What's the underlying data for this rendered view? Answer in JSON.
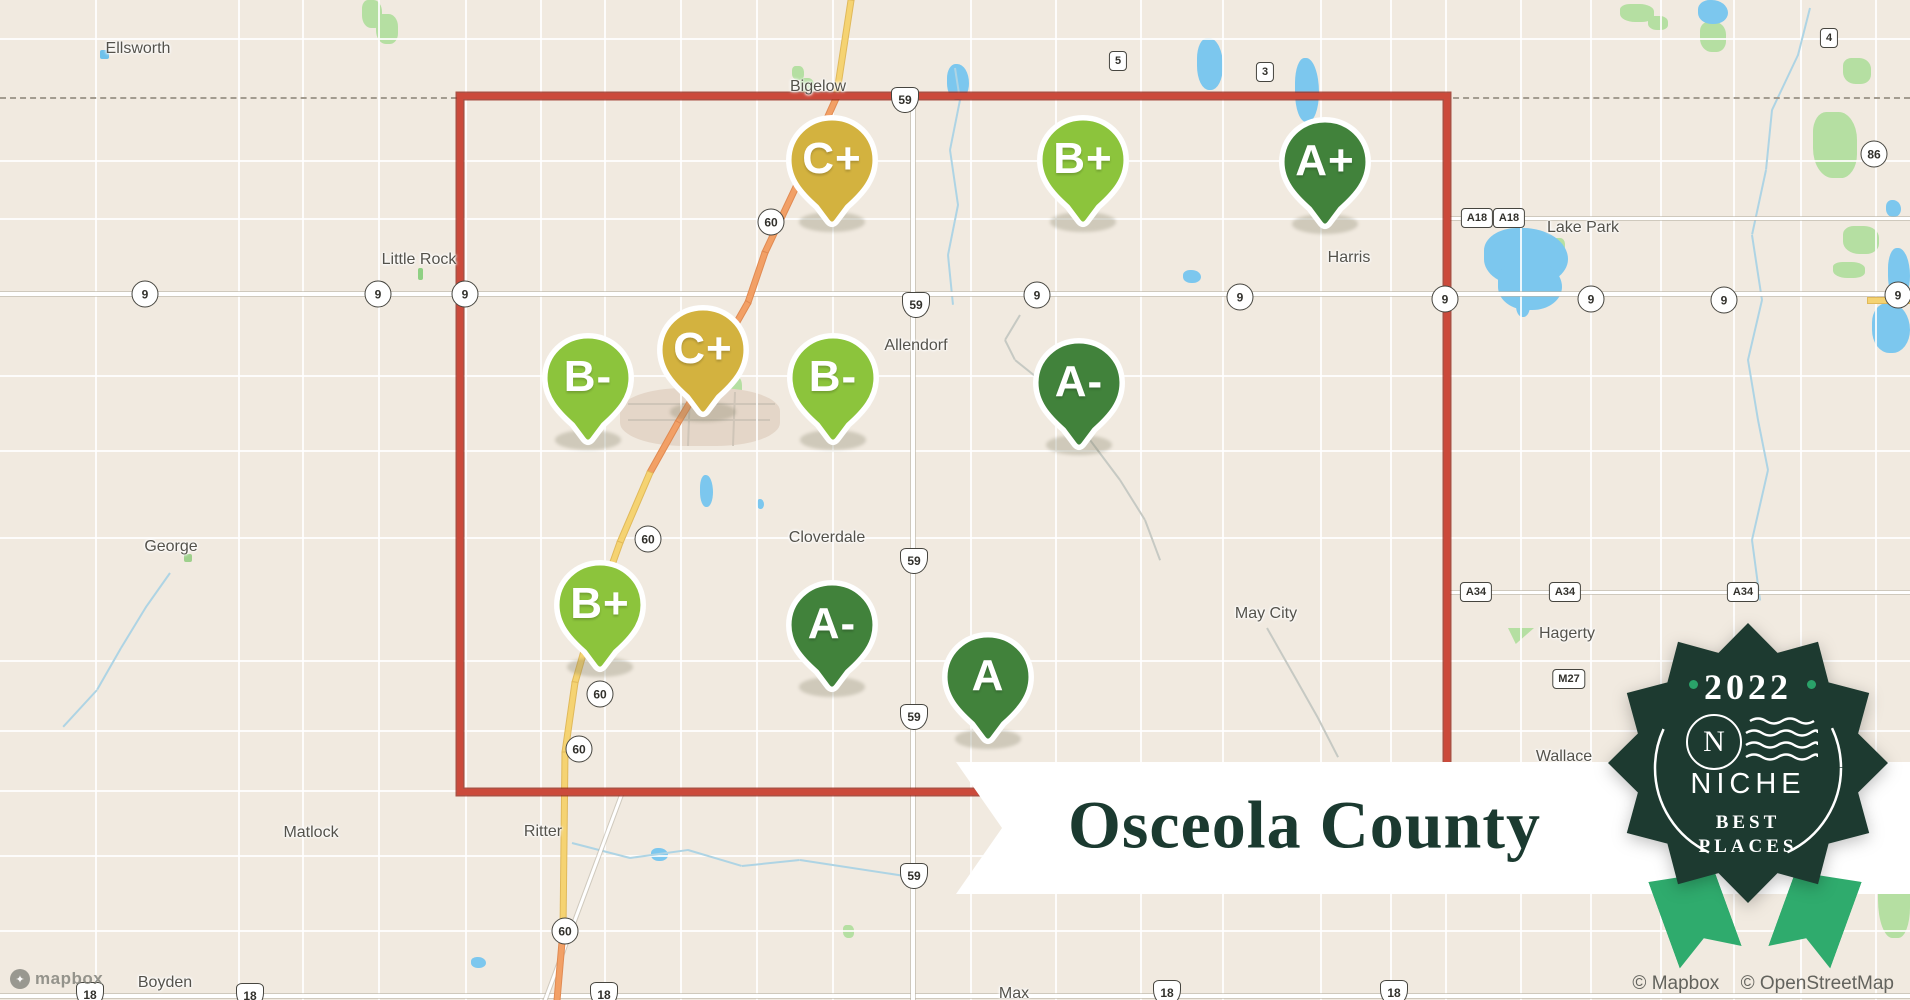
{
  "banner": {
    "title": "Osceola County"
  },
  "badge": {
    "year": "2022",
    "n": "N",
    "brand": "NICHE",
    "tagline1": "BEST",
    "tagline2": "PLACES"
  },
  "attribution": {
    "mapbox": "© Mapbox",
    "osm": "© OpenStreetMap"
  },
  "logo": {
    "text": "mapbox"
  },
  "colors": {
    "gold": "#d3b23f",
    "light_green": "#8cc43c",
    "dark_green": "#41823b",
    "county_border": "#cb4a3b",
    "water": "#7cc7ee",
    "park": "#b5dfa2",
    "road_yellow": "#f5d372",
    "road_orange": "#f2a066",
    "banner_text": "#1b3a30",
    "badge_bg": "#1d3a30",
    "ribbon": "#2fab6d",
    "badge_dot": "#2aa269"
  },
  "markers": [
    {
      "g": "C+",
      "tier": "gold",
      "x": 832,
      "y": 160
    },
    {
      "g": "B+",
      "tier": "light",
      "x": 1083,
      "y": 160
    },
    {
      "g": "A+",
      "tier": "dark",
      "x": 1325,
      "y": 162
    },
    {
      "g": "C+",
      "tier": "gold",
      "x": 703,
      "y": 350
    },
    {
      "g": "B-",
      "tier": "light",
      "x": 588,
      "y": 378
    },
    {
      "g": "B-",
      "tier": "light",
      "x": 833,
      "y": 378
    },
    {
      "g": "A-",
      "tier": "dark",
      "x": 1079,
      "y": 383
    },
    {
      "g": "B+",
      "tier": "light",
      "x": 600,
      "y": 605
    },
    {
      "g": "A-",
      "tier": "dark",
      "x": 832,
      "y": 625
    },
    {
      "g": "A",
      "tier": "dark",
      "x": 988,
      "y": 677
    }
  ],
  "towns": [
    {
      "name": "Ellsworth",
      "x": 138,
      "y": 49,
      "icon": {
        "c": "#6fc1ea",
        "x": 100,
        "y": 50,
        "w": 9,
        "h": 9
      }
    },
    {
      "name": "Bigelow",
      "x": 818,
      "y": 87
    },
    {
      "name": "Little Rock",
      "x": 419,
      "y": 260,
      "icon": {
        "c": "#8fd083",
        "x": 418,
        "y": 268,
        "w": 5,
        "h": 12
      }
    },
    {
      "name": "Harris",
      "x": 1349,
      "y": 258
    },
    {
      "name": "Lake Park",
      "x": 1583,
      "y": 228
    },
    {
      "name": "Allendorf",
      "x": 916,
      "y": 346
    },
    {
      "name": "George",
      "x": 171,
      "y": 547,
      "icon": {
        "c": "#9ed08c",
        "x": 184,
        "y": 554,
        "w": 8,
        "h": 8
      }
    },
    {
      "name": "Cloverdale",
      "x": 827,
      "y": 538
    },
    {
      "name": "May City",
      "x": 1266,
      "y": 614
    },
    {
      "name": "Hagerty",
      "x": 1567,
      "y": 634
    },
    {
      "name": "Wallace",
      "x": 1564,
      "y": 757
    },
    {
      "name": "Matlock",
      "x": 311,
      "y": 833
    },
    {
      "name": "Ritter",
      "x": 543,
      "y": 832
    },
    {
      "name": "Boyden",
      "x": 165,
      "y": 983
    },
    {
      "name": "Max",
      "x": 1014,
      "y": 994
    }
  ],
  "shields": [
    {
      "t": "c",
      "l": "9",
      "x": 145,
      "y": 294
    },
    {
      "t": "c",
      "l": "9",
      "x": 378,
      "y": 294
    },
    {
      "t": "c",
      "l": "9",
      "x": 465,
      "y": 294
    },
    {
      "t": "c",
      "l": "9",
      "x": 1037,
      "y": 295
    },
    {
      "t": "c",
      "l": "9",
      "x": 1240,
      "y": 297
    },
    {
      "t": "c",
      "l": "9",
      "x": 1445,
      "y": 299
    },
    {
      "t": "c",
      "l": "9",
      "x": 1591,
      "y": 299
    },
    {
      "t": "c",
      "l": "9",
      "x": 1724,
      "y": 300
    },
    {
      "t": "c",
      "l": "9",
      "x": 1898,
      "y": 295
    },
    {
      "t": "c",
      "l": "60",
      "x": 771,
      "y": 222
    },
    {
      "t": "c",
      "l": "60",
      "x": 648,
      "y": 539
    },
    {
      "t": "c",
      "l": "60",
      "x": 600,
      "y": 694
    },
    {
      "t": "c",
      "l": "60",
      "x": 579,
      "y": 749
    },
    {
      "t": "c",
      "l": "60",
      "x": 565,
      "y": 931
    },
    {
      "t": "c",
      "l": "86",
      "x": 1874,
      "y": 154
    },
    {
      "t": "u",
      "l": "59",
      "x": 905,
      "y": 100
    },
    {
      "t": "u",
      "l": "59",
      "x": 916,
      "y": 305
    },
    {
      "t": "u",
      "l": "59",
      "x": 914,
      "y": 561
    },
    {
      "t": "u",
      "l": "59",
      "x": 914,
      "y": 717
    },
    {
      "t": "u",
      "l": "59",
      "x": 914,
      "y": 876
    },
    {
      "t": "u",
      "l": "18",
      "x": 90,
      "y": 995
    },
    {
      "t": "u",
      "l": "18",
      "x": 250,
      "y": 996
    },
    {
      "t": "u",
      "l": "18",
      "x": 604,
      "y": 995
    },
    {
      "t": "u",
      "l": "18",
      "x": 1167,
      "y": 993
    },
    {
      "t": "u",
      "l": "18",
      "x": 1394,
      "y": 993
    },
    {
      "t": "b",
      "l": "5",
      "x": 1118,
      "y": 61
    },
    {
      "t": "b",
      "l": "3",
      "x": 1265,
      "y": 72
    },
    {
      "t": "b",
      "l": "4",
      "x": 1829,
      "y": 38
    },
    {
      "t": "b",
      "l": "A18",
      "x": 1477,
      "y": 218
    },
    {
      "t": "b",
      "l": "A18",
      "x": 1509,
      "y": 218
    },
    {
      "t": "b",
      "l": "A34",
      "x": 1476,
      "y": 592
    },
    {
      "t": "b",
      "l": "A34",
      "x": 1565,
      "y": 592
    },
    {
      "t": "b",
      "l": "A34",
      "x": 1743,
      "y": 592
    },
    {
      "t": "b",
      "l": "M27",
      "x": 1569,
      "y": 679
    }
  ],
  "map": {
    "grid": {
      "vx": [
        95,
        238,
        302,
        378,
        465,
        540,
        604,
        680,
        756,
        832,
        970,
        1055,
        1140,
        1222,
        1320,
        1390,
        1445,
        1520,
        1590,
        1660,
        1733,
        1800,
        1875
      ],
      "hy": [
        38,
        160,
        218,
        375,
        450,
        537,
        660,
        730,
        790,
        855,
        930
      ]
    },
    "roads_major": [
      {
        "x1": 0,
        "y1": 294,
        "x2": 1910,
        "y2": 294,
        "w": 4
      },
      {
        "x1": 0,
        "y1": 996,
        "x2": 1910,
        "y2": 996,
        "w": 4
      },
      {
        "x1": 913,
        "y1": 96,
        "x2": 913,
        "y2": 1000,
        "w": 4
      },
      {
        "x1": 1447,
        "y1": 592,
        "x2": 1910,
        "y2": 592,
        "w": 3
      },
      {
        "x1": 1447,
        "y1": 218,
        "x2": 1910,
        "y2": 218,
        "w": 3
      },
      {
        "x1": 622,
        "y1": 793,
        "x2": 545,
        "y2": 1000,
        "w": 3
      }
    ],
    "hwy60": [
      {
        "x1": 851,
        "y1": 0,
        "x2": 836,
        "y2": 98,
        "c": "y"
      },
      {
        "x1": 836,
        "y1": 98,
        "x2": 799,
        "y2": 180,
        "c": "o"
      },
      {
        "x1": 799,
        "y1": 180,
        "x2": 765,
        "y2": 252,
        "c": "o"
      },
      {
        "x1": 765,
        "y1": 252,
        "x2": 748,
        "y2": 302,
        "c": "o"
      },
      {
        "x1": 748,
        "y1": 302,
        "x2": 714,
        "y2": 362,
        "c": "o"
      },
      {
        "x1": 714,
        "y1": 362,
        "x2": 678,
        "y2": 422,
        "c": "o"
      },
      {
        "x1": 678,
        "y1": 422,
        "x2": 650,
        "y2": 472,
        "c": "o"
      },
      {
        "x1": 650,
        "y1": 472,
        "x2": 620,
        "y2": 542,
        "c": "y"
      },
      {
        "x1": 620,
        "y1": 542,
        "x2": 595,
        "y2": 612,
        "c": "y"
      },
      {
        "x1": 595,
        "y1": 612,
        "x2": 575,
        "y2": 682,
        "c": "y"
      },
      {
        "x1": 575,
        "y1": 682,
        "x2": 565,
        "y2": 752,
        "c": "y"
      },
      {
        "x1": 565,
        "y1": 752,
        "x2": 563,
        "y2": 930,
        "c": "y"
      },
      {
        "x1": 563,
        "y1": 930,
        "x2": 557,
        "y2": 1000,
        "c": "o"
      },
      {
        "x1": 1868,
        "y1": 300,
        "x2": 1910,
        "y2": 300,
        "c": "y"
      }
    ],
    "streams": [
      {
        "pts": [
          [
            955,
            68
          ],
          [
            960,
            100
          ],
          [
            950,
            150
          ],
          [
            958,
            205
          ],
          [
            948,
            255
          ],
          [
            953,
            305
          ]
        ]
      },
      {
        "pts": [
          [
            1810,
            8
          ],
          [
            1798,
            55
          ],
          [
            1772,
            110
          ],
          [
            1766,
            170
          ],
          [
            1752,
            235
          ],
          [
            1762,
            300
          ],
          [
            1748,
            360
          ],
          [
            1758,
            420
          ],
          [
            1768,
            470
          ],
          [
            1752,
            540
          ],
          [
            1760,
            600
          ]
        ]
      },
      {
        "pts": [
          [
            572,
            843
          ],
          [
            630,
            858
          ],
          [
            688,
            850
          ],
          [
            742,
            866
          ],
          [
            800,
            860
          ],
          [
            905,
            876
          ]
        ]
      },
      {
        "pts": [
          [
            1267,
            628
          ],
          [
            1292,
            672
          ],
          [
            1318,
            718
          ],
          [
            1338,
            757
          ]
        ],
        "c": "#c6c9c3"
      },
      {
        "pts": [
          [
            170,
            573
          ],
          [
            146,
            607
          ],
          [
            121,
            648
          ],
          [
            97,
            690
          ],
          [
            63,
            727
          ]
        ]
      },
      {
        "pts": [
          [
            1020,
            315
          ],
          [
            1005,
            340
          ],
          [
            1015,
            360
          ],
          [
            1040,
            380
          ],
          [
            1060,
            400
          ],
          [
            1090,
            440
          ],
          [
            1120,
            480
          ],
          [
            1145,
            520
          ],
          [
            1160,
            560
          ]
        ],
        "c": "#c6c9c3"
      }
    ],
    "lakes": [
      {
        "x": 947,
        "y": 64,
        "w": 22,
        "h": 36
      },
      {
        "x": 1197,
        "y": 38,
        "w": 26,
        "h": 52
      },
      {
        "x": 1295,
        "y": 58,
        "w": 24,
        "h": 64
      },
      {
        "x": 1183,
        "y": 270,
        "w": 18,
        "h": 13
      },
      {
        "x": 1484,
        "y": 228,
        "w": 84,
        "h": 58
      },
      {
        "x": 1498,
        "y": 260,
        "w": 64,
        "h": 50
      },
      {
        "x": 1516,
        "y": 293,
        "w": 14,
        "h": 24
      },
      {
        "x": 1888,
        "y": 248,
        "w": 22,
        "h": 52
      },
      {
        "x": 1872,
        "y": 303,
        "w": 38,
        "h": 50
      },
      {
        "x": 1886,
        "y": 200,
        "w": 15,
        "h": 17
      },
      {
        "x": 1698,
        "y": 0,
        "w": 30,
        "h": 24
      },
      {
        "x": 710,
        "y": 350,
        "w": 9,
        "h": 24
      },
      {
        "x": 700,
        "y": 475,
        "w": 13,
        "h": 32
      },
      {
        "x": 741,
        "y": 418,
        "w": 10,
        "h": 14
      },
      {
        "x": 757,
        "y": 499,
        "w": 7,
        "h": 10
      },
      {
        "x": 1110,
        "y": 369,
        "w": 9,
        "h": 9
      },
      {
        "x": 651,
        "y": 848,
        "w": 17,
        "h": 13
      },
      {
        "x": 471,
        "y": 957,
        "w": 15,
        "h": 11
      }
    ],
    "greens": [
      {
        "x": 362,
        "y": 0,
        "w": 20,
        "h": 28
      },
      {
        "x": 376,
        "y": 14,
        "w": 22,
        "h": 30
      },
      {
        "x": 792,
        "y": 66,
        "w": 12,
        "h": 14
      },
      {
        "x": 800,
        "y": 78,
        "w": 14,
        "h": 16
      },
      {
        "x": 1620,
        "y": 4,
        "w": 34,
        "h": 18
      },
      {
        "x": 1648,
        "y": 16,
        "w": 20,
        "h": 14
      },
      {
        "x": 1700,
        "y": 22,
        "w": 26,
        "h": 30
      },
      {
        "x": 1843,
        "y": 58,
        "w": 28,
        "h": 26
      },
      {
        "x": 1813,
        "y": 112,
        "w": 44,
        "h": 66
      },
      {
        "x": 1843,
        "y": 226,
        "w": 36,
        "h": 28
      },
      {
        "x": 1833,
        "y": 262,
        "w": 32,
        "h": 16
      },
      {
        "x": 1553,
        "y": 238,
        "w": 12,
        "h": 14
      },
      {
        "x": 1515,
        "y": 257,
        "w": 10,
        "h": 12
      },
      {
        "x": 1508,
        "y": 628,
        "w": 26,
        "h": 16,
        "clip": "polygon(0 0,100% 0,30% 100%)"
      },
      {
        "x": 1878,
        "y": 853,
        "w": 32,
        "h": 85
      },
      {
        "x": 731,
        "y": 377,
        "w": 11,
        "h": 20
      },
      {
        "x": 843,
        "y": 925,
        "w": 11,
        "h": 13
      }
    ],
    "urban": [
      {
        "x": 620,
        "y": 388,
        "w": 160,
        "h": 58
      }
    ],
    "urban_streets": [
      {
        "x1": 628,
        "y1": 404,
        "x2": 775,
        "y2": 404
      },
      {
        "x1": 628,
        "y1": 420,
        "x2": 770,
        "y2": 420
      },
      {
        "x1": 690,
        "y1": 392,
        "x2": 688,
        "y2": 446
      },
      {
        "x1": 735,
        "y1": 392,
        "x2": 733,
        "y2": 446
      }
    ]
  }
}
